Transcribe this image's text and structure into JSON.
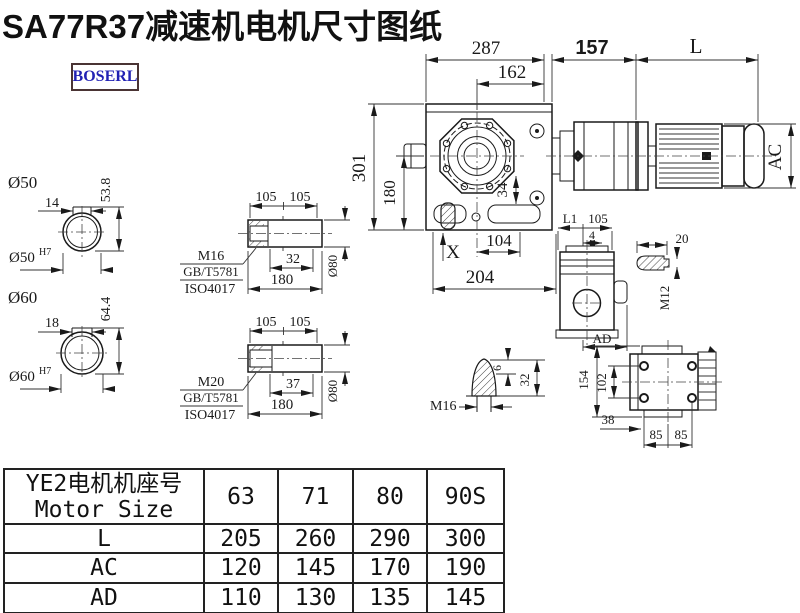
{
  "title": "SA77R37减速机电机尺寸图纸",
  "logo": "BOSERL",
  "front": {
    "d287": "287",
    "d162": "162",
    "d157": "157",
    "dL": "L",
    "d301": "301",
    "d180": "180",
    "d34": "34",
    "dX": "X",
    "d104": "104",
    "d204": "204",
    "dAC": "AC"
  },
  "side": {
    "dL1": "L1",
    "d105": "105",
    "d4": "4",
    "dAD": "AD"
  },
  "bolt_detail": {
    "d20": "20",
    "dM12": "M12"
  },
  "plug_detail": {
    "dM16": "M16",
    "d6": "6",
    "d32": "32"
  },
  "rear": {
    "d154": "154",
    "d102": "102",
    "d38": "38",
    "d85a": "85",
    "d85b": "85"
  },
  "bore50": {
    "label": "Ø50",
    "key": "14",
    "height": "53.8",
    "fit": "Ø50",
    "fit_sup": "H7"
  },
  "bore60": {
    "label": "Ø60",
    "key": "18",
    "height": "64.4",
    "fit": "Ø60",
    "fit_sup": "H7"
  },
  "shaft1": {
    "d105a": "105",
    "d105b": "105",
    "thread": "M16",
    "std1": "GB/T5781",
    "std2": "ISO4017",
    "depth": "32",
    "length": "180",
    "dia": "Ø80"
  },
  "shaft2": {
    "d105a": "105",
    "d105b": "105",
    "thread": "M20",
    "std1": "GB/T5781",
    "std2": "ISO4017",
    "depth": "37",
    "length": "180",
    "dia": "Ø80"
  },
  "table": {
    "header_cn": "YE2电机机座号",
    "header_en": "Motor Size",
    "sizes": [
      "63",
      "71",
      "80",
      "90S"
    ],
    "rows": [
      {
        "label": "L",
        "values": [
          "205",
          "260",
          "290",
          "300"
        ]
      },
      {
        "label": "AC",
        "values": [
          "120",
          "145",
          "170",
          "190"
        ]
      },
      {
        "label": "AD",
        "values": [
          "110",
          "130",
          "135",
          "145"
        ]
      }
    ]
  }
}
